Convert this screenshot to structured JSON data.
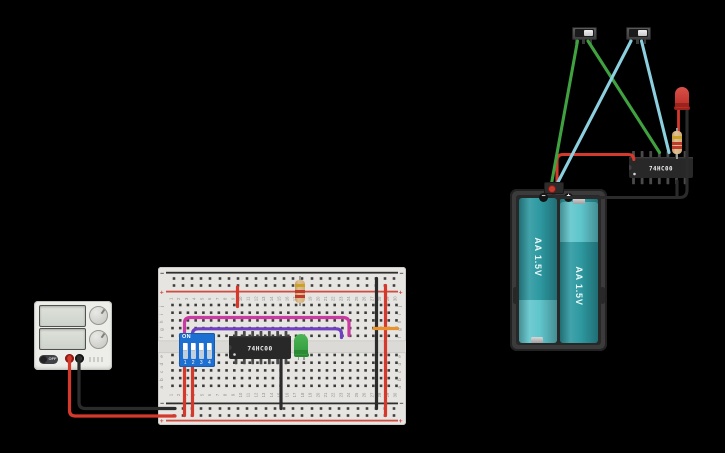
{
  "power_supply": {
    "off_label": "OFF"
  },
  "breadboard": {
    "row_letters_top": [
      "j",
      "i",
      "h",
      "g",
      "f"
    ],
    "row_letters_bottom": [
      "e",
      "d",
      "c",
      "b",
      "a"
    ],
    "column_numbers": [
      "1",
      "2",
      "3",
      "4",
      "5",
      "6",
      "7",
      "8",
      "9",
      "10",
      "11",
      "12",
      "13",
      "14",
      "15",
      "16",
      "17",
      "18",
      "19",
      "20",
      "21",
      "22",
      "23",
      "24",
      "25",
      "26",
      "27",
      "28",
      "29",
      "30"
    ],
    "plus": "+",
    "minus": "−"
  },
  "dip_switch": {
    "on_label": "ON",
    "positions": [
      "1",
      "2",
      "3",
      "4"
    ],
    "states": [
      "up",
      "up",
      "up",
      "up"
    ]
  },
  "ics": {
    "breadboard_label": "74HC00",
    "right_label": "74HC00"
  },
  "battery_pack": {
    "battery1_label": "AA 1.5V",
    "battery2_label": "AA 1.5V",
    "minus": "−",
    "plus": "+"
  },
  "colors": {
    "wire_red": "#d5392c",
    "wire_black": "#2b2b2b",
    "wire_green": "#3fa13f",
    "wire_cyan": "#8ccfdf",
    "wire_magenta": "#cb3aa2",
    "wire_purple": "#7140c2",
    "wire_orange": "#e8932f",
    "breadboard_body": "#e6e5e1",
    "dip_switch_blue": "#1d6fd1",
    "ic_body": "#282828",
    "battery_teal_dark": "#2d99a1",
    "battery_teal_light": "#5fc6cc",
    "led_green": "#3aa547",
    "led_red": "#c8352b",
    "resistor_body": "#d4ab77",
    "resistor_bands": [
      "#c9a227",
      "#bf3a2e",
      "#bf3a2e"
    ]
  }
}
